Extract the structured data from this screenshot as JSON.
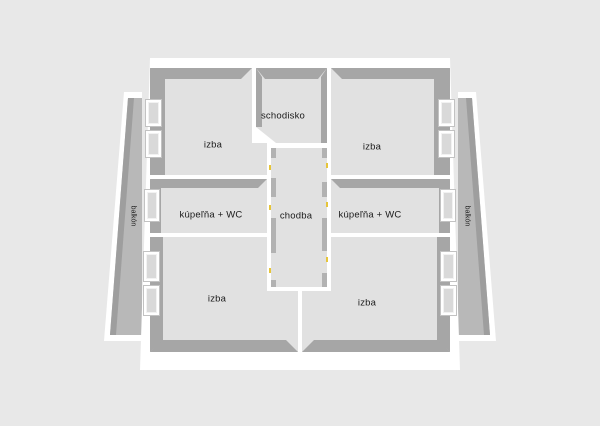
{
  "canvas": {
    "width": 600,
    "height": 426,
    "background": "#e8e8e8"
  },
  "colors": {
    "building_wall": "#ffffff",
    "room_floor": "#e1e1e1",
    "wall_inner_shade": "#a6a6a6",
    "corridor_wall_shade": "#b2b2b2",
    "balcony_floor": "#b8b8b8",
    "balcony_rail_shade": "#9e9e9e",
    "window_pane": "#d9d9d9",
    "door_hinge": "#e6c53a",
    "label_text": "#1a1a1a"
  },
  "rooms": [
    {
      "id": "izba-top-left",
      "label": "izba"
    },
    {
      "id": "schodisko",
      "label": "schodisko"
    },
    {
      "id": "izba-top-right",
      "label": "izba"
    },
    {
      "id": "kupelna-wc-left",
      "label": "kúpeľňa + WC"
    },
    {
      "id": "chodba",
      "label": "chodba"
    },
    {
      "id": "kupelna-wc-right",
      "label": "kúpeľňa + WC"
    },
    {
      "id": "izba-bottom-left",
      "label": "izba"
    },
    {
      "id": "izba-bottom-right",
      "label": "izba"
    }
  ],
  "balconies": [
    {
      "id": "balcony-left",
      "label": "balkón"
    },
    {
      "id": "balcony-right",
      "label": "balkón"
    }
  ]
}
